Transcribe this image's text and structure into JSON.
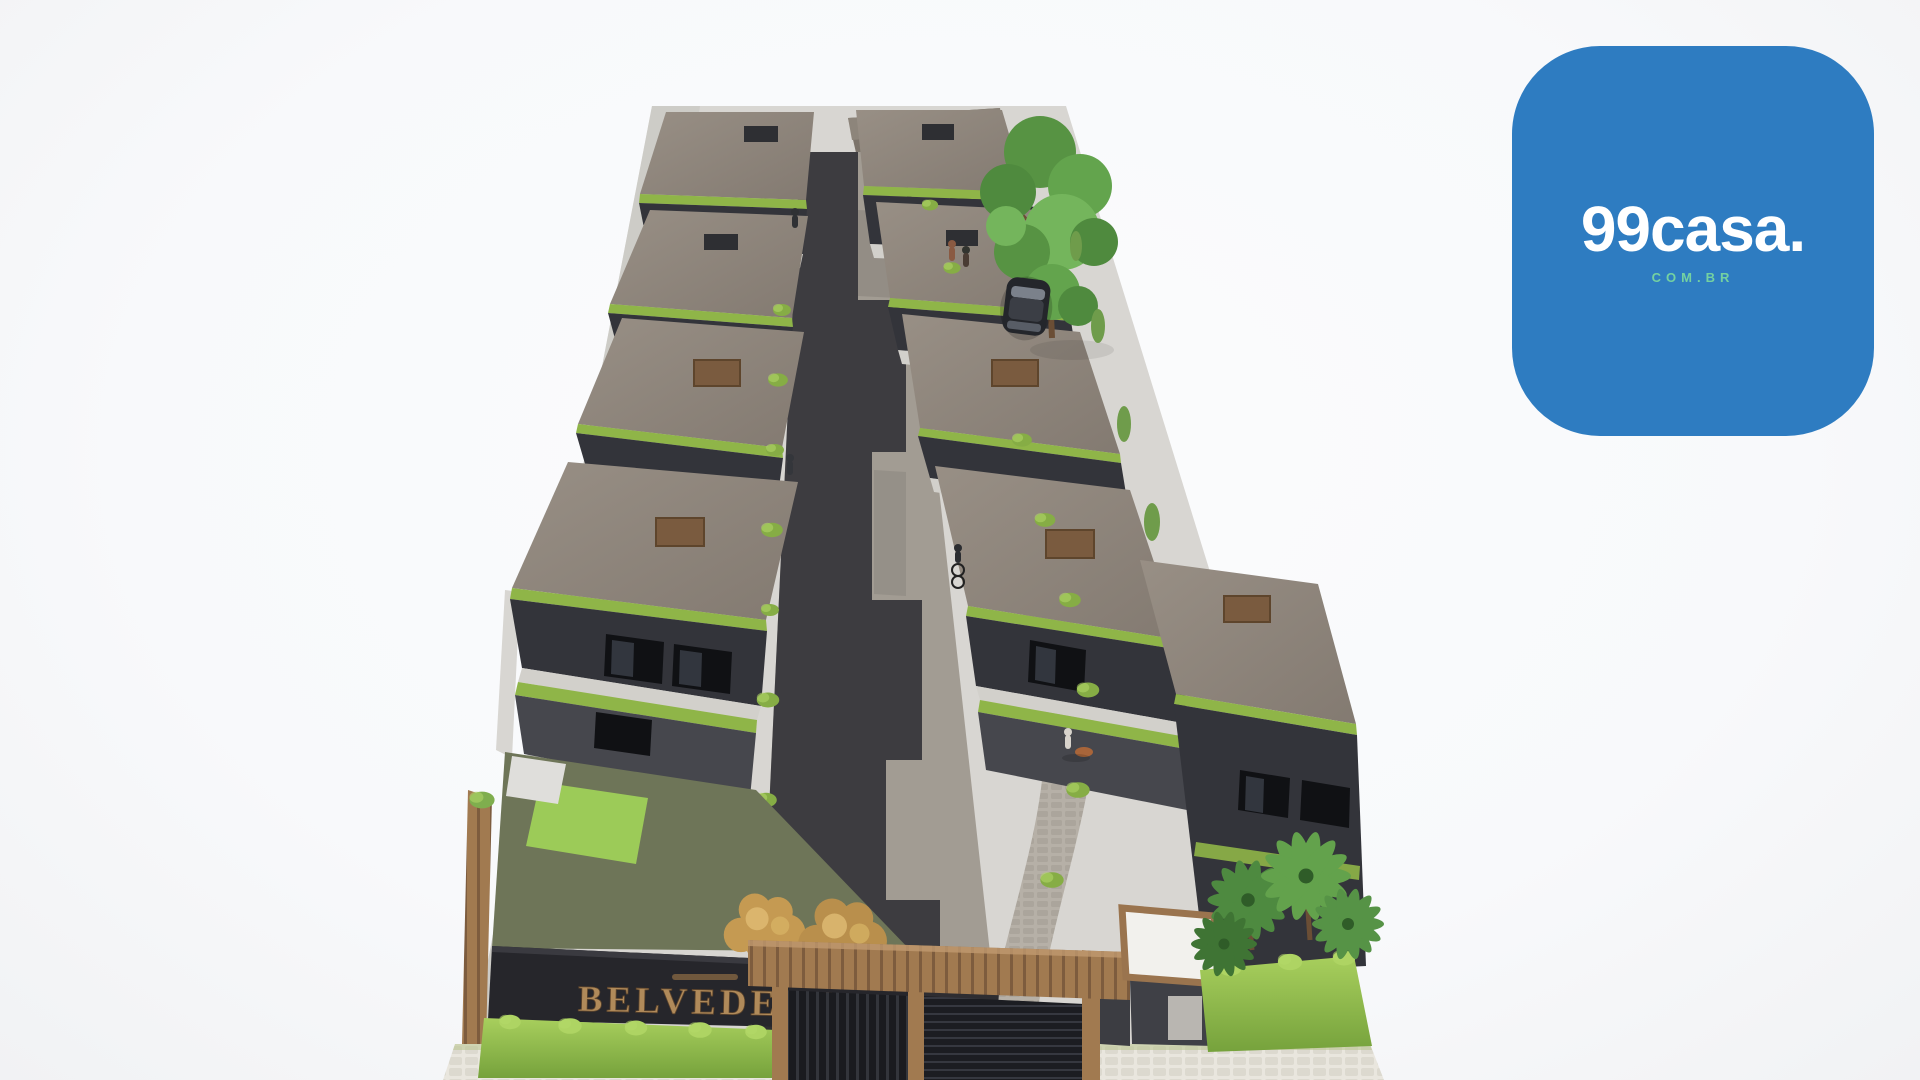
{
  "page": {
    "description_label": "3D aerial rendering of a gated townhouse condominium with central driveway"
  },
  "watermark_logo": {
    "brand": "99casa.",
    "domain": "COM.BR"
  },
  "render": {
    "entrance_sign": "BELVEDERE"
  },
  "colors": {
    "background": "#f8f9fb",
    "logo_blue": "#2e7cc1",
    "logo_text": "#ffffff",
    "logo_domain_green": "#74d1a1",
    "roof": "#8e857b",
    "wall_dark": "#33343a",
    "wall_light": "#d8d6d2",
    "ivy": "#8fb548",
    "hedge": "#9cc353",
    "lawn": "#9ccb58",
    "pavement": "#a29c93",
    "walkway": "#b6b0a7",
    "drive_shadow": "#39383c",
    "wood": "#a17a50",
    "gate_dark": "#1a1b1f",
    "bronze": "#b08a5a",
    "gold_foliage": "#c59a52",
    "palm_green": "#4e8a40",
    "tree_green": "#579343",
    "sidewalk": "#e9e6de",
    "guard_roof": "#f2f1ed"
  }
}
